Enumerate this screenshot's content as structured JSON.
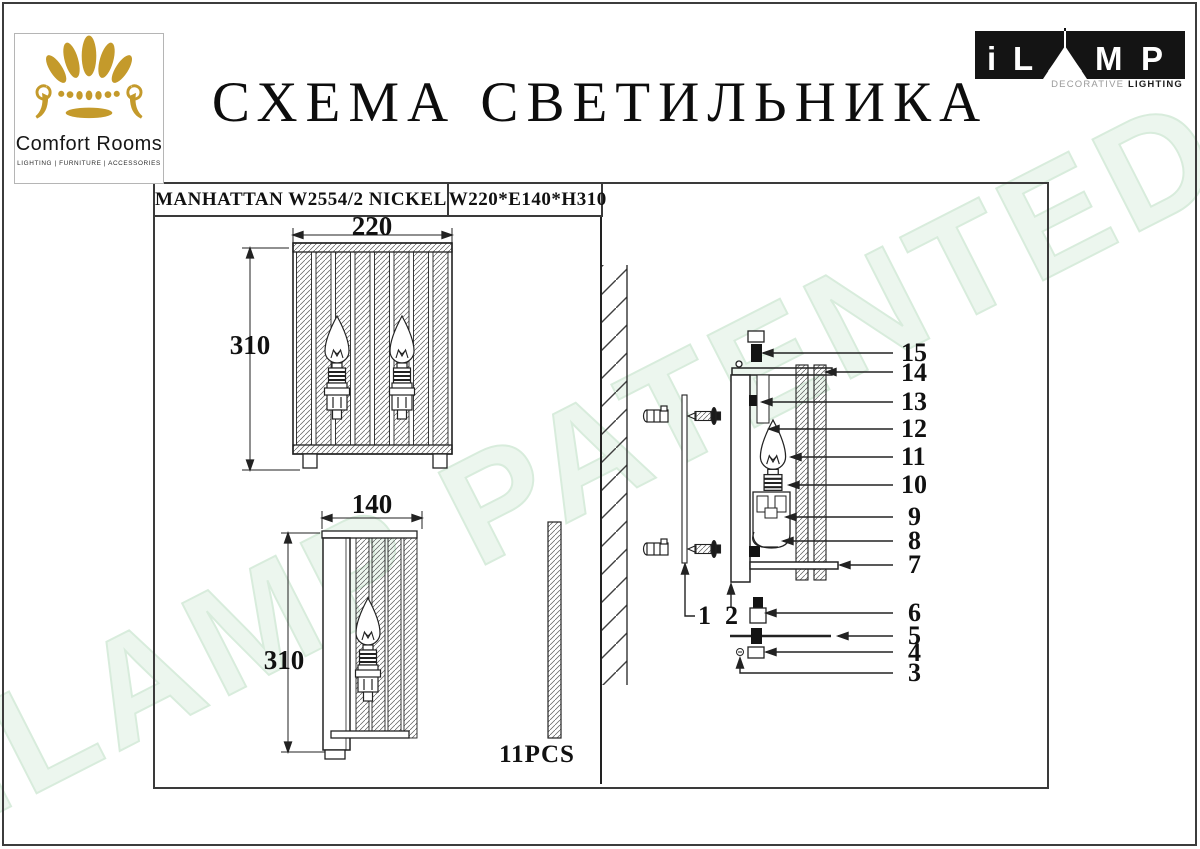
{
  "page": {
    "title": "СХЕМА СВЕТИЛЬНИКА"
  },
  "brand": {
    "name": "Comfort Rooms",
    "tagline": "LIGHTING  |  FURNITURE  |  ACCESSORIES",
    "gold": "#c49a2b"
  },
  "ilamp": {
    "letters": {
      "i": "i",
      "l": "L",
      "m": "M",
      "p": "P"
    },
    "subtitle_light": "DECORATIVE ",
    "subtitle_bold": "LIGHTING"
  },
  "spec": {
    "model": "MANHATTAN W2554/2 NICKEL",
    "size": "W220*E140*H310"
  },
  "views": {
    "front": {
      "width_label": "220",
      "height_label": "310"
    },
    "side": {
      "width_label": "140",
      "height_label": "310"
    }
  },
  "crystal": {
    "pcs_label": "11PCS"
  },
  "exploded": {
    "callouts": [
      {
        "label": "15"
      },
      {
        "label": "14"
      },
      {
        "label": "13"
      },
      {
        "label": "12"
      },
      {
        "label": "11"
      },
      {
        "label": "10"
      },
      {
        "label": "9"
      },
      {
        "label": "8"
      },
      {
        "label": "7"
      },
      {
        "label": "6"
      },
      {
        "label": "5"
      },
      {
        "label": "4"
      },
      {
        "label": "3"
      },
      {
        "label": "1"
      },
      {
        "label": "2"
      }
    ]
  },
  "watermark": {
    "text": "iLAMP PATENTED",
    "color": "#e9f4eb"
  }
}
